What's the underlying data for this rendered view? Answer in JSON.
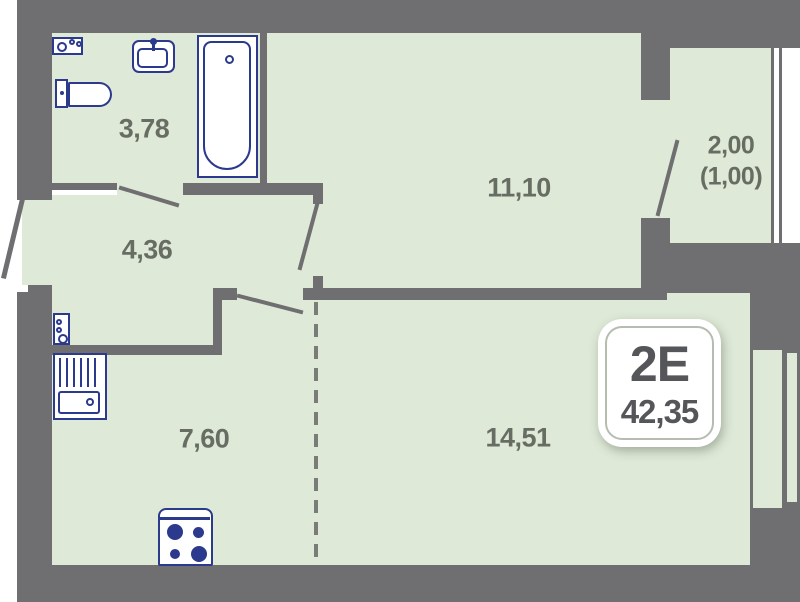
{
  "badge": {
    "type_label": "2Е",
    "total_area": "42,35"
  },
  "rooms": {
    "bathroom": {
      "area": "3,78"
    },
    "hallway": {
      "area": "4,36"
    },
    "bedroom": {
      "area": "11,10"
    },
    "balcony": {
      "area": "2,00",
      "area_coefficient": "(1,00)"
    },
    "kitchen": {
      "area": "7,60"
    },
    "living": {
      "area": "14,51"
    }
  },
  "fixtures": [
    {
      "name": "electrical-panel"
    },
    {
      "name": "washbasin"
    },
    {
      "name": "bathtub"
    },
    {
      "name": "toilet"
    },
    {
      "name": "meter-box"
    },
    {
      "name": "kitchen-sink"
    },
    {
      "name": "stove"
    }
  ],
  "colors": {
    "wall": "#6f6f71",
    "floor": "#dee9d7",
    "fixture_outline": "#2b3a8c",
    "label_text": "#686d64",
    "badge_text": "#55565a",
    "background": "#ffffff"
  }
}
